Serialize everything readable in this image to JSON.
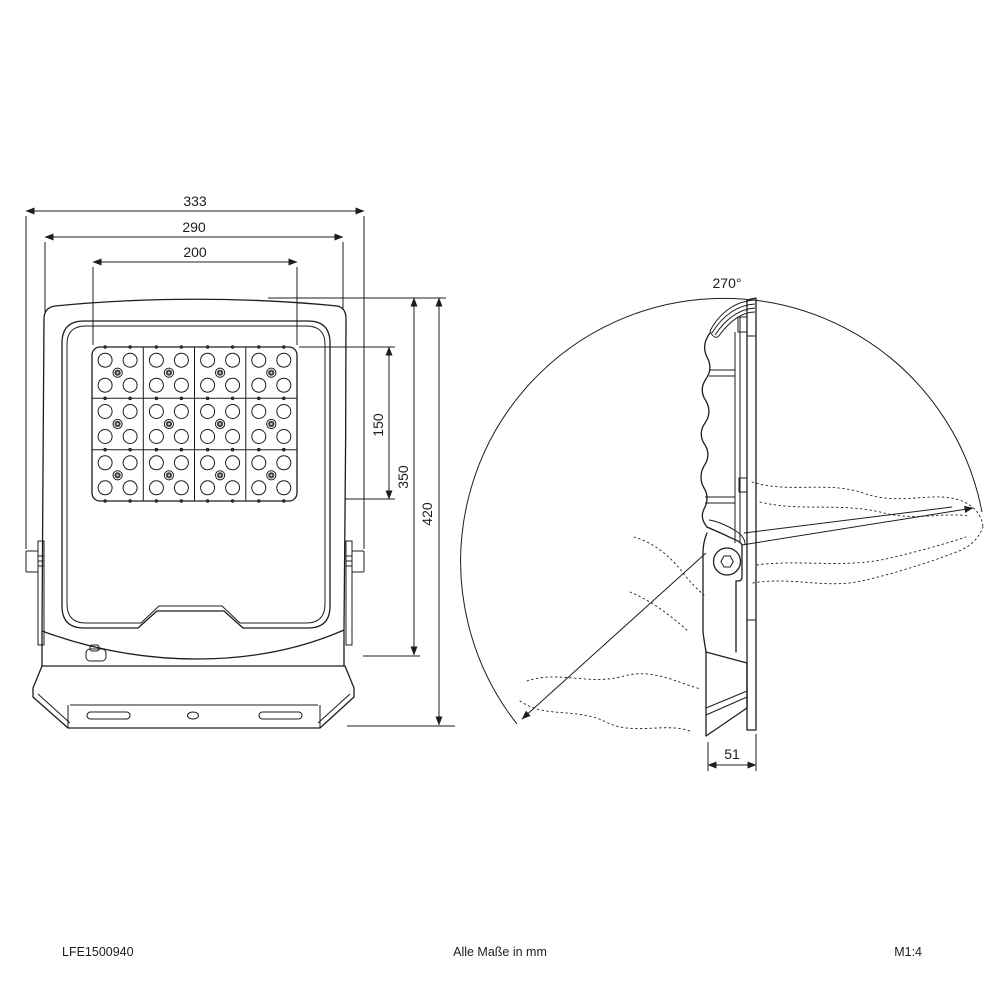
{
  "drawing": {
    "title": "floodlight-dimension-drawing",
    "front_view": {
      "dim_width_total": "333",
      "dim_width_body": "290",
      "dim_width_led": "200",
      "dim_height_led": "150",
      "dim_height_body": "350",
      "dim_height_total": "420"
    },
    "side_view": {
      "dim_rotation": "270°",
      "dim_depth": "51"
    },
    "footer": {
      "left": "LFE1500940",
      "center": "Alle Maße in mm",
      "right": "M1:4"
    },
    "colors": {
      "line": "#1d1d1d",
      "background": "#ffffff",
      "screw_dark": "#3f3f3f",
      "screw_light": "#c4c4c4"
    }
  }
}
